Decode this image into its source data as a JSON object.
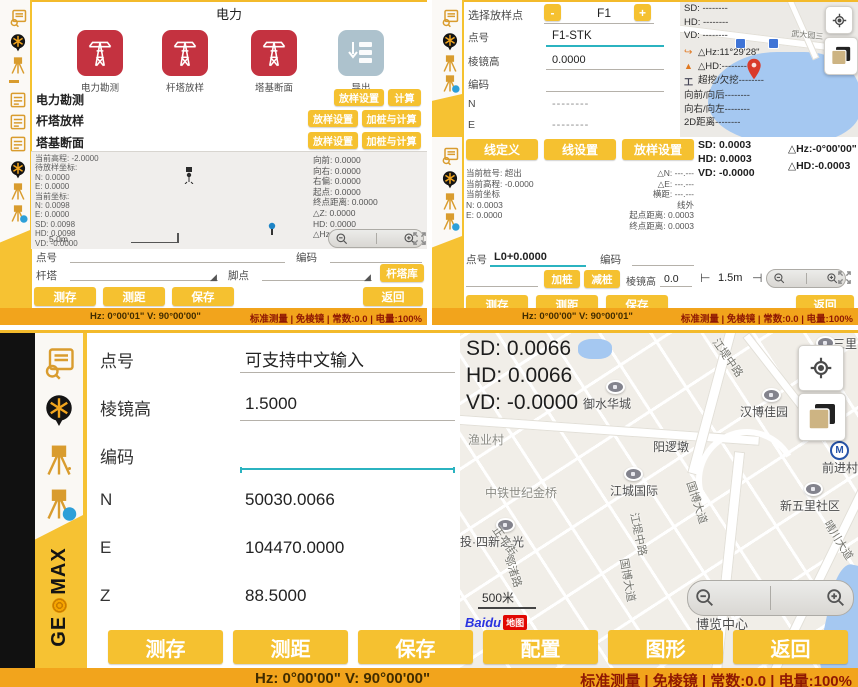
{
  "brand": {
    "ge": "GE",
    "max": "MAX"
  },
  "status_info": "标准测量 | 免棱镜 | 常数:0.0 | 电量:100%",
  "icons": {
    "data-manager": "list-with-magnifier",
    "prism": "circle-target",
    "station": "tripod",
    "station-info": "tripod-info-badge",
    "power-tower": "transmission-tower",
    "export": "server-download",
    "locate": "crosshair",
    "layers": "stacked-sheets",
    "zoom-in": "magnifier-plus",
    "zoom-out": "magnifier-minus",
    "expand": "arrows-out",
    "pin": "map-pin",
    "metro": "M",
    "dropdown": "◢"
  },
  "top_left": {
    "title": "电力",
    "tiles": [
      "电力勘测",
      "杆塔放样",
      "塔基断面",
      "导出"
    ],
    "menu": [
      {
        "label": "电力勘测",
        "btn1": "放样设置",
        "btn2": "计算"
      },
      {
        "label": "杆塔放样",
        "btn1": "放样设置",
        "btn2": "加桩与计算"
      },
      {
        "label": "塔基断面",
        "btn1": "放样设置",
        "btn2": "加桩与计算"
      }
    ],
    "display": {
      "left_lines": [
        "当前高程: -2.0000",
        "待放样坐标:",
        "N: 0.0000",
        "E: 0.0000",
        "当前坐标:",
        "N: 0.0098",
        "E: 0.0000",
        "SD: 0.0098",
        "HD: 0.0098",
        "VD: -0.0000"
      ],
      "right_lines": [
        "向前: 0.0000",
        "向右: 0.0000",
        "右偏: 0.0000",
        "起点: 0.0000",
        "终点距离: 0.0000",
        "△Z: 0.0000",
        "HD: 0.0000",
        "△Hz:-0°00'01\""
      ],
      "scale": "5.0m"
    },
    "fields": {
      "point": "点号",
      "code": "编码",
      "tower": "杆塔",
      "foot": "脚点",
      "tower_lib": "杆塔库"
    },
    "buttons": [
      "测存",
      "测距",
      "保存",
      "返回"
    ],
    "status_hz": "Hz: 0°00'01\" V: 90°00'00\""
  },
  "top_right": {
    "select": {
      "label": "选择放样点",
      "minus": "-",
      "value": "F1",
      "plus": "+"
    },
    "fields": [
      {
        "label": "点号",
        "value": "F1-STK"
      },
      {
        "label": "棱镜高",
        "value": "0.0000"
      },
      {
        "label": "编码",
        "value": ""
      },
      {
        "label": "N",
        "value": "--------"
      },
      {
        "label": "E",
        "value": "--------"
      }
    ],
    "map": {
      "dist_lines": [
        "SD: --------",
        "HD: --------",
        "VD: --------"
      ],
      "hz": "△Hz:11°29'28\"",
      "hd": "△HD:--------",
      "cut": "超挖/欠挖--------",
      "more_lines": [
        "向前/向后--------",
        "向右/向左--------",
        "2D距离--------"
      ],
      "road": "武大园三"
    },
    "line_buttons": [
      "线定义",
      "线设置",
      "放样设置"
    ],
    "result_lines": [
      "SD: 0.0003",
      "HD: 0.0003",
      "VD: -0.0000"
    ],
    "delta_lines": [
      "△Hz:-0°00'00\"",
      "△HD:-0.0003"
    ],
    "info_left": [
      "当前桩号: 超出",
      "当前高程: -0.0000",
      "当前坐标",
      "N: 0.0003",
      "E: 0.0000"
    ],
    "info_right": [
      "△N: ---.---",
      "△E: ---.---",
      "横距: ---.---",
      "线外",
      "起点距离: 0.0003",
      "终点距离: 0.0003"
    ],
    "point": {
      "label": "点号",
      "value": "L0+0.0000",
      "code_label": "编码"
    },
    "stake": {
      "add": "加桩",
      "sub": "减桩",
      "prism_label": "棱镜高",
      "prism_value": "0.0",
      "scale": "1.5m"
    },
    "buttons": [
      "测存",
      "测距",
      "保存",
      "返回"
    ],
    "status_hz": "Hz: 0°00'00\" V: 90°00'01\""
  },
  "bottom": {
    "fields": [
      {
        "label": "点号",
        "value": "可支持中文输入"
      },
      {
        "label": "棱镜高",
        "value": "1.5000"
      },
      {
        "label": "编码",
        "value": ""
      },
      {
        "label": "N",
        "value": "50030.0066"
      },
      {
        "label": "E",
        "value": "104470.0000"
      },
      {
        "label": "Z",
        "value": "88.5000"
      }
    ],
    "overlay_lines": [
      "SD: 0.0066",
      "HD: 0.0066",
      "VD: -0.0000"
    ],
    "map_labels": [
      "三里",
      "御水华城",
      "汉博佳园",
      "渔业村",
      "阳逻墩",
      "前进村",
      "中铁世纪金桥",
      "江城国际",
      "新五里社区",
      "投·四新之光",
      "正平街",
      "鄂渚路",
      "江堤中路",
      "国博大道",
      "晴川大道",
      "江堤中路",
      "国博大道",
      "武",
      "博览中心"
    ],
    "scale_label": "500米",
    "logo_main": "Baidu",
    "logo_tag": "地图",
    "buttons": [
      "测存",
      "测距",
      "保存",
      "配置",
      "图形",
      "返回"
    ],
    "status_hz": "Hz: 0°00'00\" V: 90°00'00\""
  }
}
